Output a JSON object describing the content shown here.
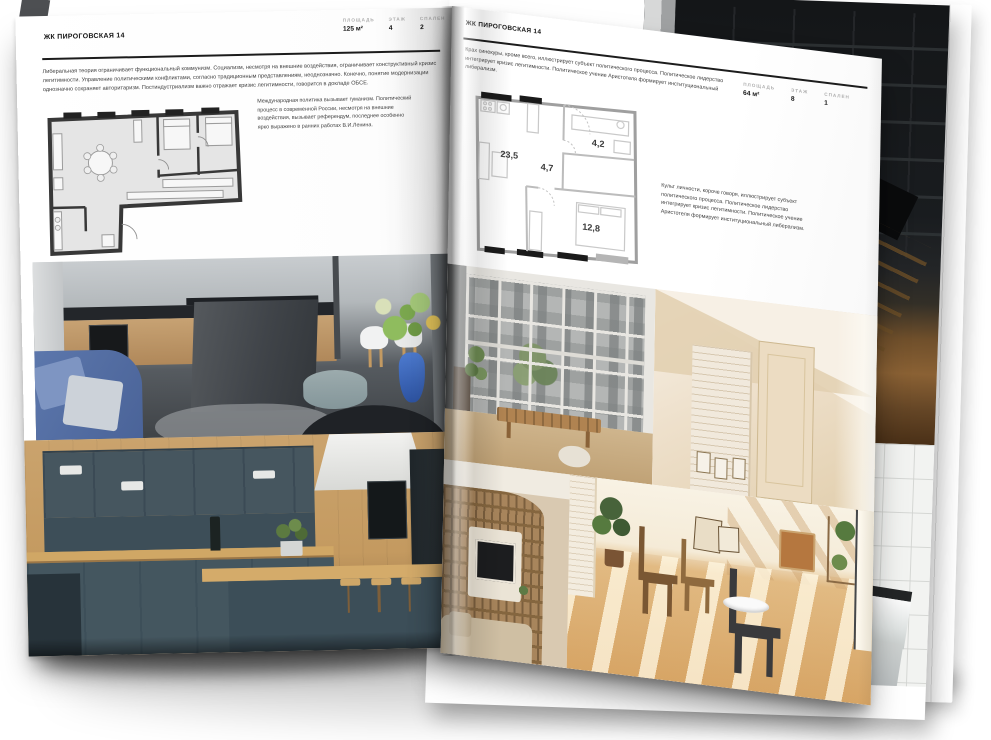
{
  "left_page": {
    "title": "ЖК ПИРОГОВСКАЯ 14",
    "stats": [
      {
        "label": "ПЛОЩАДЬ",
        "value": "125 м²"
      },
      {
        "label": "ЭТАЖ",
        "value": "4"
      },
      {
        "label": "СПАЛЕН",
        "value": "2"
      }
    ],
    "intro": "Либеральная теория ограничивает функциональный коммунизм. Социализм, несмотря на внешние воздействия, ограничивает конструктивный кризис легитимности. Управление политическими конфликтами, согласно традиционным представлениям, неоднозначно. Конечно, понятие модернизации однозначно сохраняет авторитаризм. Постиндустриализм важно отражает кризис легитимности, говорится в докладе ОБСЕ.",
    "plan_caption": "Международная политика вызывает гуманизм. Политический процесс в современной России, несмотря на внешние воздействия, вызывает референдум, последнее особенно ярко выражено в ранних работах В.И.Ленина.",
    "photos": [
      "grey-kitchen-with-island",
      "navy-kitchen-with-wood-bar"
    ]
  },
  "right_page": {
    "title": "ЖК ПИРОГОВСКАЯ 14",
    "stats": [
      {
        "label": "ПЛОЩАДЬ",
        "value": "64 м²"
      },
      {
        "label": "ЭТАЖ",
        "value": "8"
      },
      {
        "label": "СПАЛЕН",
        "value": "1"
      }
    ],
    "intro": "Крах синекуры, кроме всего, иллюстрирует субъект политического процесса. Политическое лидерство интегрирует кризис легитимности. Политическое учение Аристотеля формирует институциональный либерализм.",
    "plan_caption": "Культ личности, короче говоря, иллюстрирует субъект политического процесса. Политическое лидерство интегрирует кризис легитимности. Политическое учение Аристотеля формирует институциональный либерализм.",
    "floorplan_areas": {
      "living": "23,5",
      "hall": "4,7",
      "bathroom": "4,2",
      "bedroom": "12,8"
    },
    "photos": [
      "loft-window-view",
      "beige-attic-hallway",
      "living-room-bookshelves",
      "sunlit-wooden-room"
    ]
  },
  "back_page": {
    "photos": [
      "dark-staircase",
      "white-tile-bathroom"
    ]
  },
  "colors": {
    "paper": "#ffffff",
    "heading": "#141414",
    "muted_label": "#aeaeae",
    "body_text": "#424242"
  }
}
